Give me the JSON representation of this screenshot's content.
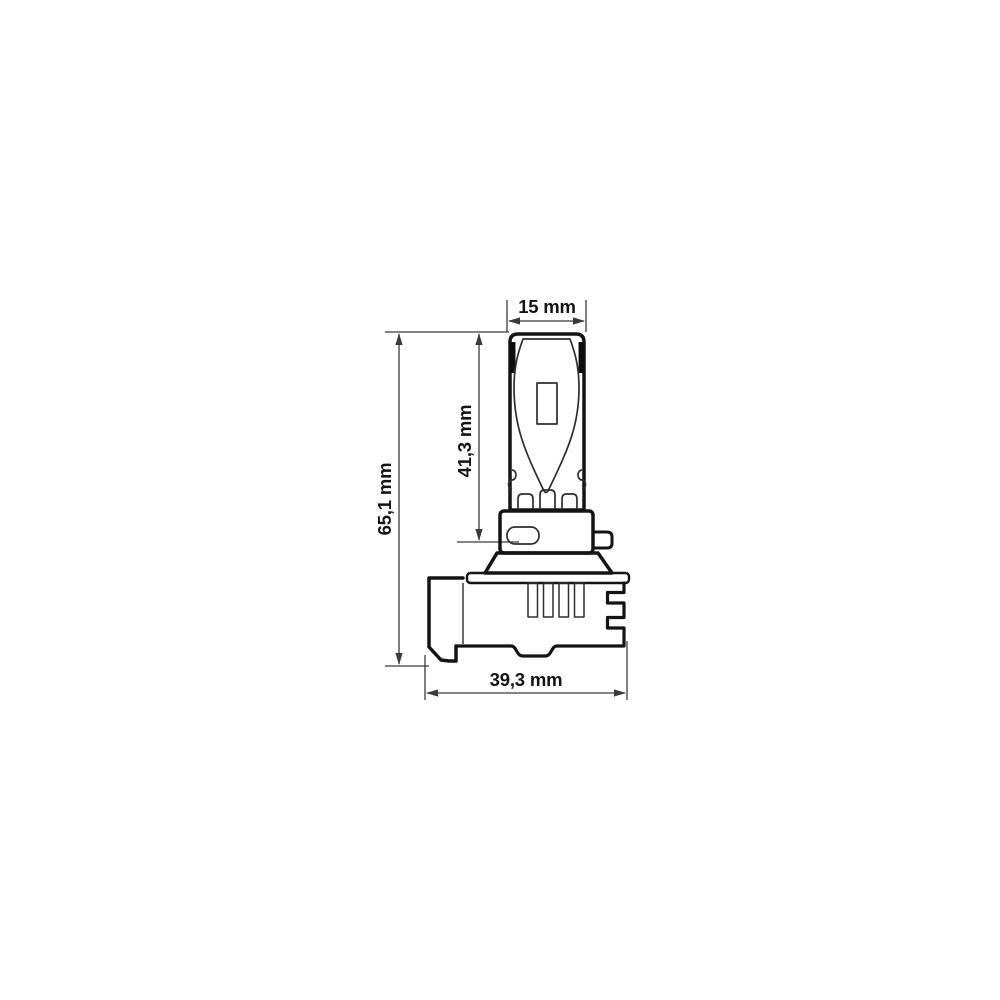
{
  "drawing": {
    "kind": "dimensioned technical drawing of an LED bulb (side view)",
    "dimensions": {
      "top_width": {
        "label": "15 mm"
      },
      "upper_height": {
        "label": "41,3 mm"
      },
      "total_height": {
        "label": "65,1 mm"
      },
      "base_width": {
        "label": "39,3 mm"
      }
    },
    "colors": {
      "background": "#ffffff",
      "outline": "#141414",
      "detail_line": "#2e2e2e",
      "dimension_line": "#3a3a3a",
      "text": "#141414"
    }
  }
}
